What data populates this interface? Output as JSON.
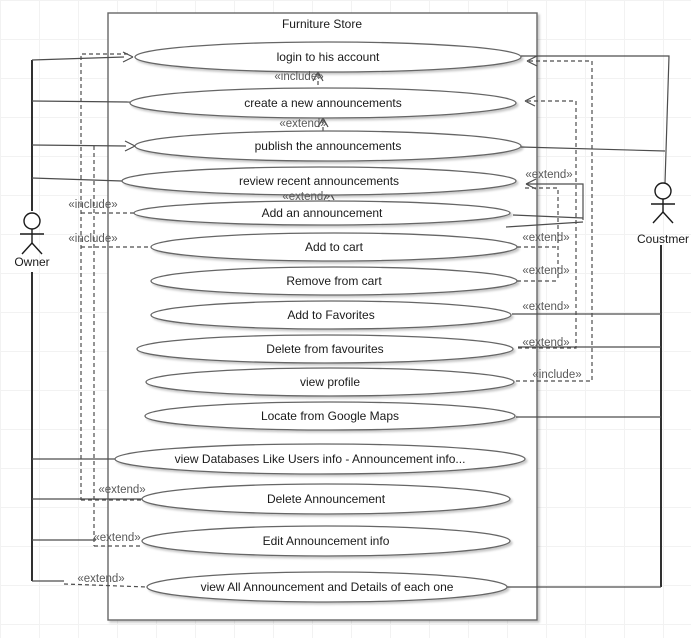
{
  "diagram": {
    "title": "Furniture Store",
    "actors": {
      "left": "Owner",
      "right": "Coustmer"
    },
    "usecases": [
      "login to his account",
      "create a new announcements",
      "publish the announcements",
      "review recent announcements",
      "Add an announcement",
      "Add to cart",
      "Remove from cart",
      "Add to Favorites",
      "Delete from favourites",
      "view profile",
      "Locate from Google Maps",
      "view Databases Like Users info - Announcement info...",
      "Delete Announcement",
      "Edit Announcement info",
      "view All Announcement and Details of each one"
    ],
    "stereotypes": {
      "include": "«include»",
      "extend": "«extend»"
    },
    "colors": {
      "background": "#ffffff",
      "grid": "#f2f2f2",
      "shape_stroke": "#666666",
      "connector": "#4d4d4d",
      "text": "#1a1a1a",
      "stereotype_text": "#595959"
    }
  }
}
